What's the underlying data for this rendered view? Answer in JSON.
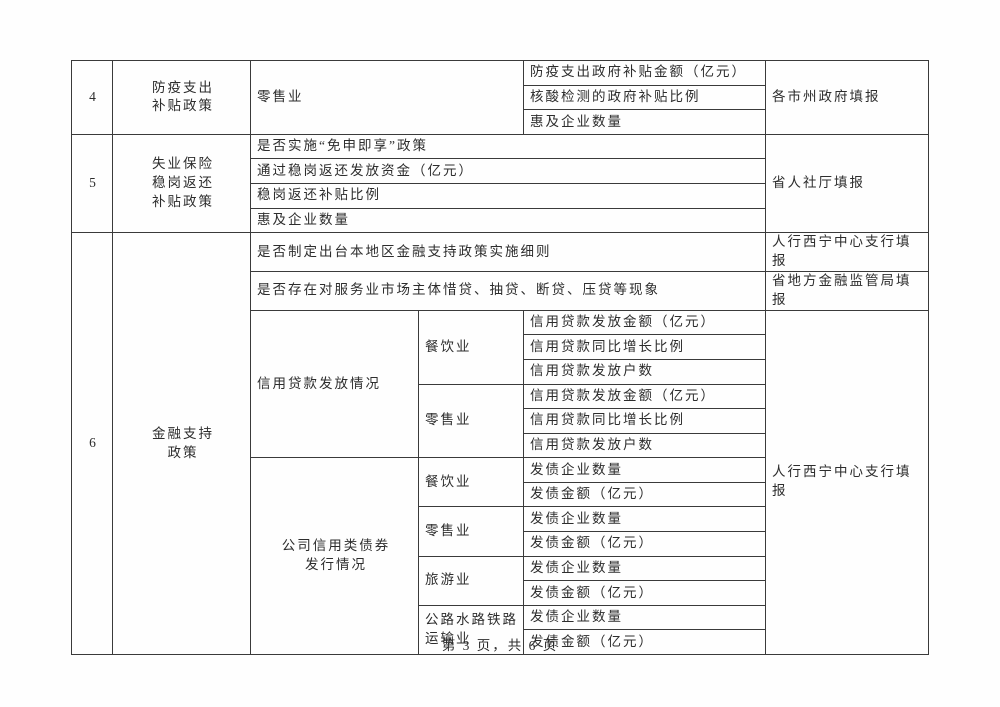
{
  "footer": {
    "page_indicator": "第 3 页，共 6 页"
  },
  "table": {
    "row4": {
      "no": "4",
      "policy_line1": "防疫支出",
      "policy_line2": "补贴政策",
      "industry": "零售业",
      "items": [
        "防疫支出政府补贴金额（亿元）",
        "核酸检测的政府补贴比例",
        "惠及企业数量"
      ],
      "filler": "各市州政府填报"
    },
    "row5": {
      "no": "5",
      "policy_line1": "失业保险",
      "policy_line2": "稳岗返还",
      "policy_line3": "补贴政策",
      "items": [
        "是否实施“免申即享”政策",
        "通过稳岗返还发放资金（亿元）",
        "稳岗返还补贴比例",
        "惠及企业数量"
      ],
      "filler": "省人社厅填报"
    },
    "row6": {
      "no": "6",
      "policy_line1": "金融支持",
      "policy_line2": "政策",
      "q1": "是否制定出台本地区金融支持政策实施细则",
      "q1_filler": "人行西宁中心支行填报",
      "q2": "是否存在对服务业市场主体惜贷、抽贷、断贷、压贷等现象",
      "q2_filler": "省地方金融监管局填报",
      "credit": {
        "label": "信用贷款发放情况",
        "industries": [
          {
            "name": "餐饮业",
            "items": [
              "信用贷款发放金额（亿元）",
              "信用贷款同比增长比例",
              "信用贷款发放户数"
            ]
          },
          {
            "name": "零售业",
            "items": [
              "信用贷款发放金额（亿元）",
              "信用贷款同比增长比例",
              "信用贷款发放户数"
            ]
          }
        ]
      },
      "bonds": {
        "label_line1": "公司信用类债券",
        "label_line2": "发行情况",
        "industries": [
          {
            "name": "餐饮业",
            "items": [
              "发债企业数量",
              "发债金额（亿元）"
            ]
          },
          {
            "name": "零售业",
            "items": [
              "发债企业数量",
              "发债金额（亿元）"
            ]
          },
          {
            "name": "旅游业",
            "items": [
              "发债企业数量",
              "发债金额（亿元）"
            ]
          },
          {
            "name": "公路水路铁路运输业",
            "items": [
              "发债企业数量",
              "发债金额（亿元）"
            ]
          }
        ]
      },
      "filler": "人行西宁中心支行填报"
    }
  }
}
